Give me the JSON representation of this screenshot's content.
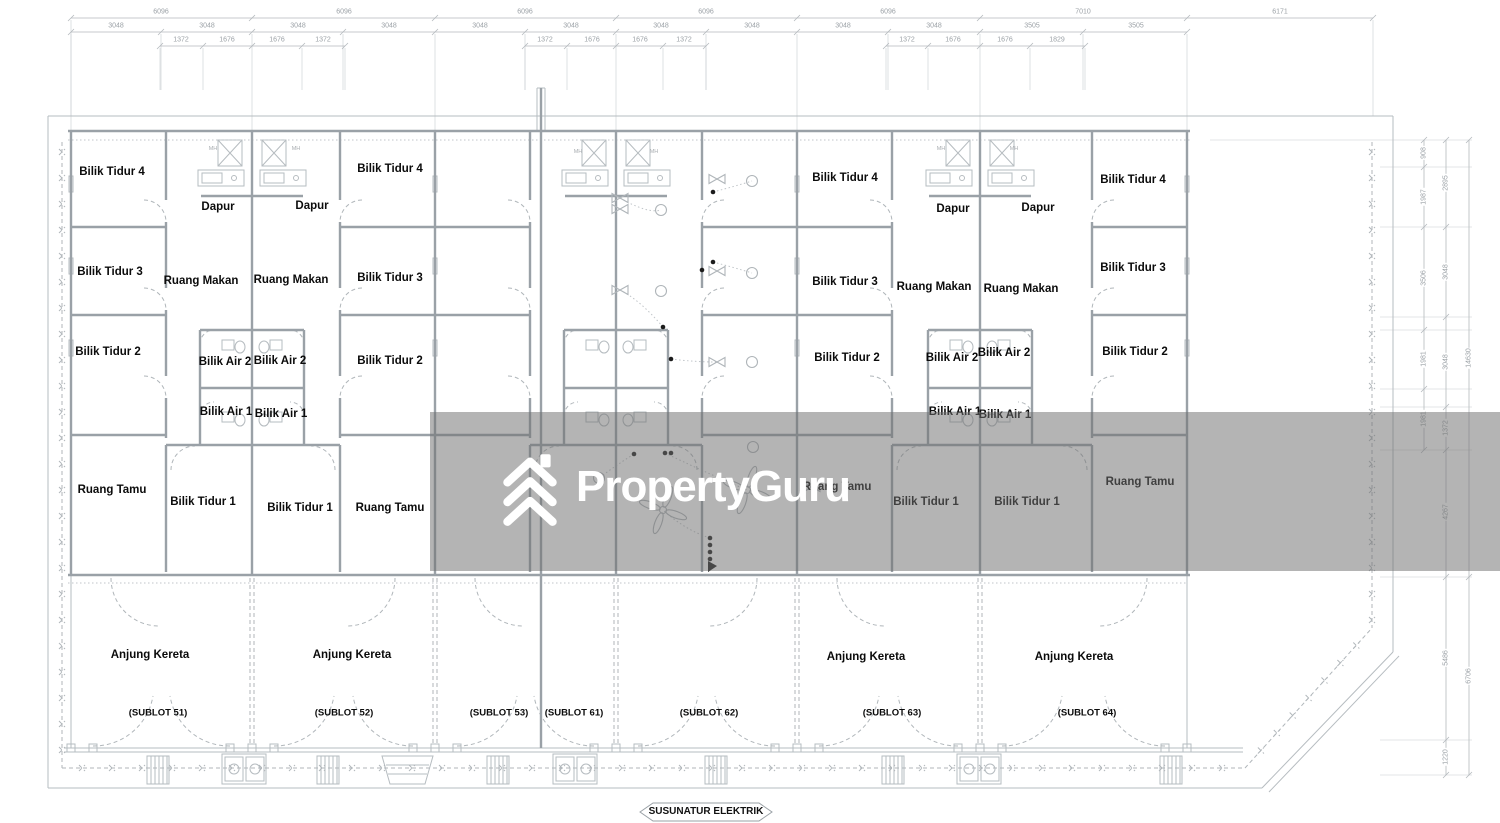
{
  "watermark": {
    "brand": "PropertyGuru",
    "band_color": "#707070"
  },
  "footer": {
    "label": "SUSUNATUR ELEKTRIK"
  },
  "colors": {
    "line": "#a9aeb3",
    "wall": "#9aa1a7",
    "text": "#0b0b0b",
    "dim_text": "#9ba1a6",
    "watermark_logo": "#ffffff"
  },
  "labels": {
    "rooms": [
      {
        "text": "Bilik Tidur 4",
        "x": 112,
        "y": 172
      },
      {
        "text": "Dapur",
        "x": 218,
        "y": 207
      },
      {
        "text": "Dapur",
        "x": 312,
        "y": 206
      },
      {
        "text": "Bilik Tidur 4",
        "x": 390,
        "y": 169
      },
      {
        "text": "Bilik Tidur 3",
        "x": 110,
        "y": 272
      },
      {
        "text": "Ruang Makan",
        "x": 201,
        "y": 281
      },
      {
        "text": "Ruang Makan",
        "x": 291,
        "y": 280
      },
      {
        "text": "Bilik Tidur 3",
        "x": 390,
        "y": 278
      },
      {
        "text": "Bilik Tidur 2",
        "x": 108,
        "y": 352
      },
      {
        "text": "Bilik Air 2",
        "x": 225,
        "y": 362
      },
      {
        "text": "Bilik Air 2",
        "x": 280,
        "y": 361
      },
      {
        "text": "Bilik Tidur 2",
        "x": 390,
        "y": 361
      },
      {
        "text": "Bilik Air 1",
        "x": 226,
        "y": 412
      },
      {
        "text": "Bilik Air 1",
        "x": 281,
        "y": 414
      },
      {
        "text": "Ruang Tamu",
        "x": 112,
        "y": 490
      },
      {
        "text": "Bilik Tidur 1",
        "x": 203,
        "y": 502
      },
      {
        "text": "Bilik Tidur 1",
        "x": 300,
        "y": 508
      },
      {
        "text": "Ruang Tamu",
        "x": 390,
        "y": 508
      },
      {
        "text": "Anjung Kereta",
        "x": 150,
        "y": 655
      },
      {
        "text": "Anjung Kereta",
        "x": 352,
        "y": 655
      },
      {
        "text": "Bilik Tidur 4",
        "x": 845,
        "y": 178
      },
      {
        "text": "Dapur",
        "x": 953,
        "y": 209
      },
      {
        "text": "Dapur",
        "x": 1038,
        "y": 208
      },
      {
        "text": "Bilik Tidur 4",
        "x": 1133,
        "y": 180
      },
      {
        "text": "Bilik Tidur 3",
        "x": 845,
        "y": 282
      },
      {
        "text": "Ruang Makan",
        "x": 934,
        "y": 287
      },
      {
        "text": "Ruang Makan",
        "x": 1021,
        "y": 289
      },
      {
        "text": "Bilik Tidur 3",
        "x": 1133,
        "y": 268
      },
      {
        "text": "Bilik Tidur 2",
        "x": 847,
        "y": 358
      },
      {
        "text": "Bilik Air 2",
        "x": 952,
        "y": 358
      },
      {
        "text": "Bilik Air 2",
        "x": 1004,
        "y": 353
      },
      {
        "text": "Bilik Tidur 2",
        "x": 1135,
        "y": 352
      },
      {
        "text": "Bilik Air 1",
        "x": 955,
        "y": 412
      },
      {
        "text": "Bilik Air 1",
        "x": 1005,
        "y": 415
      },
      {
        "text": "Ruang Tamu",
        "x": 837,
        "y": 487
      },
      {
        "text": "Bilik Tidur 1",
        "x": 926,
        "y": 502
      },
      {
        "text": "Bilik Tidur 1",
        "x": 1027,
        "y": 502
      },
      {
        "text": "Ruang Tamu",
        "x": 1140,
        "y": 482
      },
      {
        "text": "Anjung Kereta",
        "x": 866,
        "y": 657
      },
      {
        "text": "Anjung Kereta",
        "x": 1074,
        "y": 657
      }
    ],
    "sublots": [
      {
        "text": "(SUBLOT 51)",
        "x": 158,
        "y": 713
      },
      {
        "text": "(SUBLOT 52)",
        "x": 344,
        "y": 713
      },
      {
        "text": "(SUBLOT 53)",
        "x": 499,
        "y": 713
      },
      {
        "text": "(SUBLOT 61)",
        "x": 574,
        "y": 713
      },
      {
        "text": "(SUBLOT 62)",
        "x": 709,
        "y": 713
      },
      {
        "text": "(SUBLOT 63)",
        "x": 892,
        "y": 713
      },
      {
        "text": "(SUBLOT 64)",
        "x": 1087,
        "y": 713
      }
    ],
    "mh": [
      {
        "text": "MH",
        "x": 213,
        "y": 149
      },
      {
        "text": "MH",
        "x": 296,
        "y": 149
      },
      {
        "text": "MH",
        "x": 578,
        "y": 152
      },
      {
        "text": "MH",
        "x": 654,
        "y": 152
      },
      {
        "text": "MH",
        "x": 941,
        "y": 149
      },
      {
        "text": "MH",
        "x": 1014,
        "y": 149
      }
    ],
    "dims_top": [
      {
        "text": "6096",
        "x": 161,
        "y": 12
      },
      {
        "text": "6096",
        "x": 344,
        "y": 12
      },
      {
        "text": "6096",
        "x": 525,
        "y": 12
      },
      {
        "text": "6096",
        "x": 706,
        "y": 12
      },
      {
        "text": "6096",
        "x": 888,
        "y": 12
      },
      {
        "text": "7010",
        "x": 1083,
        "y": 12
      },
      {
        "text": "6171",
        "x": 1280,
        "y": 12
      },
      {
        "text": "3048",
        "x": 116,
        "y": 26
      },
      {
        "text": "3048",
        "x": 207,
        "y": 26
      },
      {
        "text": "3048",
        "x": 298,
        "y": 26
      },
      {
        "text": "3048",
        "x": 389,
        "y": 26
      },
      {
        "text": "3048",
        "x": 480,
        "y": 26
      },
      {
        "text": "3048",
        "x": 571,
        "y": 26
      },
      {
        "text": "3048",
        "x": 661,
        "y": 26
      },
      {
        "text": "3048",
        "x": 752,
        "y": 26
      },
      {
        "text": "3048",
        "x": 843,
        "y": 26
      },
      {
        "text": "3048",
        "x": 934,
        "y": 26
      },
      {
        "text": "3505",
        "x": 1032,
        "y": 26
      },
      {
        "text": "3505",
        "x": 1136,
        "y": 26
      },
      {
        "text": "1372",
        "x": 181,
        "y": 40
      },
      {
        "text": "1676",
        "x": 227,
        "y": 40
      },
      {
        "text": "1676",
        "x": 277,
        "y": 40
      },
      {
        "text": "1372",
        "x": 323,
        "y": 40
      },
      {
        "text": "1372",
        "x": 545,
        "y": 40
      },
      {
        "text": "1676",
        "x": 592,
        "y": 40
      },
      {
        "text": "1676",
        "x": 640,
        "y": 40
      },
      {
        "text": "1372",
        "x": 684,
        "y": 40
      },
      {
        "text": "1372",
        "x": 907,
        "y": 40
      },
      {
        "text": "1676",
        "x": 953,
        "y": 40
      },
      {
        "text": "1676",
        "x": 1005,
        "y": 40
      },
      {
        "text": "1829",
        "x": 1057,
        "y": 40
      }
    ],
    "dims_right": [
      {
        "text": "908",
        "x": 1424,
        "y": 153
      },
      {
        "text": "1987",
        "x": 1424,
        "y": 197
      },
      {
        "text": "3506",
        "x": 1424,
        "y": 278
      },
      {
        "text": "1981",
        "x": 1424,
        "y": 359
      },
      {
        "text": "1981",
        "x": 1424,
        "y": 419
      },
      {
        "text": "2895",
        "x": 1446,
        "y": 183
      },
      {
        "text": "3048",
        "x": 1446,
        "y": 272
      },
      {
        "text": "3048",
        "x": 1446,
        "y": 362
      },
      {
        "text": "1372",
        "x": 1446,
        "y": 428
      },
      {
        "text": "4267",
        "x": 1446,
        "y": 512
      },
      {
        "text": "5486",
        "x": 1446,
        "y": 658
      },
      {
        "text": "1220",
        "x": 1446,
        "y": 757
      },
      {
        "text": "14630",
        "x": 1469,
        "y": 358
      },
      {
        "text": "6706",
        "x": 1469,
        "y": 676
      }
    ]
  }
}
